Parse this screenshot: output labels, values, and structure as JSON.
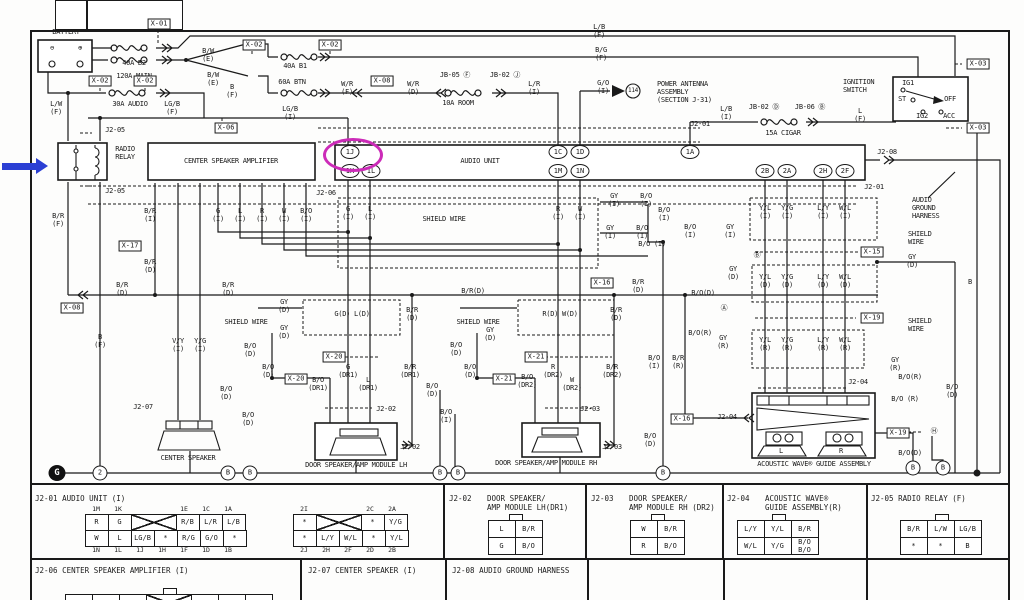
{
  "annotations": {
    "highlighted_pin": "1J",
    "highlight_color": "#cc2bb8",
    "pointer_arrow_color": "#2b3fd4",
    "pointer_target": "RADIO RELAY"
  },
  "diagram": {
    "wire_labels": [
      {
        "t": "BATTERY",
        "x": 66,
        "y": 32,
        "n": "battery-title"
      },
      {
        "t": "⊖",
        "x": 52,
        "y": 48
      },
      {
        "t": "⊕",
        "x": 80,
        "y": 48
      },
      {
        "t": "40A B2",
        "x": 134,
        "y": 63
      },
      {
        "t": "120A MAIN",
        "x": 134,
        "y": 76
      },
      {
        "t": "B/W\n(E)",
        "x": 208,
        "y": 55
      },
      {
        "t": "B/W\n(E)",
        "x": 213,
        "y": 79
      },
      {
        "t": "B\n(F)",
        "x": 232,
        "y": 91
      },
      {
        "t": "30A AUDIO",
        "x": 130,
        "y": 104
      },
      {
        "t": "L/W\n(F)",
        "x": 56,
        "y": 108
      },
      {
        "t": "LG/B\n(F)",
        "x": 172,
        "y": 108
      },
      {
        "t": "40A B1",
        "x": 295,
        "y": 66
      },
      {
        "t": "60A BTN",
        "x": 292,
        "y": 82
      },
      {
        "t": "W/R\n(F)",
        "x": 347,
        "y": 88
      },
      {
        "t": "W/R\n(D)",
        "x": 413,
        "y": 88
      },
      {
        "t": "JB-05 Ⓕ",
        "x": 455,
        "y": 75
      },
      {
        "t": "JB-02 Ⓙ",
        "x": 505,
        "y": 75
      },
      {
        "t": "10A ROOM",
        "x": 458,
        "y": 103
      },
      {
        "t": "L/R\n(I)",
        "x": 534,
        "y": 88
      },
      {
        "t": "LG/B\n(I)",
        "x": 290,
        "y": 113
      },
      {
        "t": "L/B\n(F)",
        "x": 599,
        "y": 31
      },
      {
        "t": "B/G\n(F)",
        "x": 601,
        "y": 54
      },
      {
        "t": "G/O\n(I)",
        "x": 603,
        "y": 87
      },
      {
        "t": "114",
        "x": 633,
        "y": 91,
        "s": 1
      },
      {
        "t": "POWER ANTENNA\nASSEMBLY\n(SECTION J-31)",
        "x": 657,
        "y": 92,
        "a": 1,
        "n": "power-antenna-title"
      },
      {
        "t": "IGNITION\nSWITCH",
        "x": 843,
        "y": 86,
        "a": 1,
        "n": "ignition-switch-title"
      },
      {
        "t": "IG1",
        "x": 908,
        "y": 83
      },
      {
        "t": "ST",
        "x": 902,
        "y": 99
      },
      {
        "t": "OFF",
        "x": 950,
        "y": 99
      },
      {
        "t": "IG2",
        "x": 922,
        "y": 116
      },
      {
        "t": "ACC",
        "x": 949,
        "y": 116
      },
      {
        "t": "JB-02 Ⓓ",
        "x": 764,
        "y": 107
      },
      {
        "t": "JB-06 Ⓑ",
        "x": 810,
        "y": 107
      },
      {
        "t": "15A CIGAR",
        "x": 783,
        "y": 133
      },
      {
        "t": "L/B\n(I)",
        "x": 726,
        "y": 113
      },
      {
        "t": "L\n(F)",
        "x": 860,
        "y": 115
      },
      {
        "t": "J2-01",
        "x": 700,
        "y": 124
      },
      {
        "t": "J2-05",
        "x": 115,
        "y": 130
      },
      {
        "t": "J2-05",
        "x": 115,
        "y": 191
      },
      {
        "t": "RADIO\nRELAY",
        "x": 125,
        "y": 153,
        "n": "radio-relay-title"
      },
      {
        "t": "CENTER SPEAKER AMPLIFIER",
        "x": 231,
        "y": 161,
        "n": "center-speaker-amplifier-title"
      },
      {
        "t": "AUDIO UNIT",
        "x": 480,
        "y": 161,
        "n": "audio-unit-title"
      },
      {
        "t": "J2-06",
        "x": 326,
        "y": 193
      },
      {
        "t": "J2-08",
        "x": 887,
        "y": 152
      },
      {
        "t": "J2-01",
        "x": 874,
        "y": 187
      },
      {
        "t": "AUDIO\nGROUND\nHARNESS",
        "x": 912,
        "y": 208,
        "a": 1,
        "n": "audio-ground-harness-label"
      },
      {
        "t": "B/R\n(F)",
        "x": 58,
        "y": 220
      },
      {
        "t": "B/R\n(I)",
        "x": 150,
        "y": 215
      },
      {
        "t": "G\n(I)",
        "x": 218,
        "y": 215
      },
      {
        "t": "L\n(I)",
        "x": 240,
        "y": 215
      },
      {
        "t": "R\n(I)",
        "x": 262,
        "y": 215
      },
      {
        "t": "W\n(I)",
        "x": 284,
        "y": 215
      },
      {
        "t": "B/O\n(I)",
        "x": 306,
        "y": 215
      },
      {
        "t": "B/R\n(D)",
        "x": 150,
        "y": 266
      },
      {
        "t": "B/R\n(D)",
        "x": 122,
        "y": 289
      },
      {
        "t": "B/R\n(D)",
        "x": 228,
        "y": 289
      },
      {
        "t": "G\n(I)",
        "x": 348,
        "y": 213
      },
      {
        "t": "L\n(I)",
        "x": 370,
        "y": 213
      },
      {
        "t": "SHIELD WIRE",
        "x": 444,
        "y": 219
      },
      {
        "t": "R\n(I)",
        "x": 558,
        "y": 213
      },
      {
        "t": "W\n(I)",
        "x": 580,
        "y": 213
      },
      {
        "t": "GY\n(I)",
        "x": 614,
        "y": 200
      },
      {
        "t": "B/O\n(I)",
        "x": 646,
        "y": 200
      },
      {
        "t": "GY\n(I)",
        "x": 610,
        "y": 232
      },
      {
        "t": "B/O\n(I)",
        "x": 642,
        "y": 232
      },
      {
        "t": "B/O (I)",
        "x": 652,
        "y": 244
      },
      {
        "t": "B/O\n(I)",
        "x": 664,
        "y": 214
      },
      {
        "t": "B/O\n(I)",
        "x": 690,
        "y": 231
      },
      {
        "t": "GY\n(I)",
        "x": 730,
        "y": 231
      },
      {
        "t": "Y/L\n(I)",
        "x": 765,
        "y": 212
      },
      {
        "t": "Y/G\n(I)",
        "x": 787,
        "y": 212
      },
      {
        "t": "L/Y\n(I)",
        "x": 823,
        "y": 212
      },
      {
        "t": "W/L\n(I)",
        "x": 845,
        "y": 212
      },
      {
        "t": "SHIELD\nWIRE",
        "x": 908,
        "y": 238,
        "a": 1
      },
      {
        "t": "Ⓑ",
        "x": 757,
        "y": 255
      },
      {
        "t": "GY\n(D)",
        "x": 912,
        "y": 261
      },
      {
        "t": "Y/L\n(D)",
        "x": 765,
        "y": 281
      },
      {
        "t": "Y/G\n(D)",
        "x": 787,
        "y": 281
      },
      {
        "t": "L/Y\n(D)",
        "x": 823,
        "y": 281
      },
      {
        "t": "W/L\n(D)",
        "x": 845,
        "y": 281
      },
      {
        "t": "GY\n(D)",
        "x": 733,
        "y": 273
      },
      {
        "t": "B/O(D)",
        "x": 703,
        "y": 293
      },
      {
        "t": "Ⓐ",
        "x": 724,
        "y": 308
      },
      {
        "t": "SHIELD\nWIRE",
        "x": 908,
        "y": 325,
        "a": 1
      },
      {
        "t": "B",
        "x": 970,
        "y": 282
      },
      {
        "t": "B/R(D)",
        "x": 473,
        "y": 291
      },
      {
        "t": "B/R\n(D)",
        "x": 638,
        "y": 286
      },
      {
        "t": "B\n(F)",
        "x": 100,
        "y": 341
      },
      {
        "t": "V/Y\n(I)",
        "x": 178,
        "y": 345
      },
      {
        "t": "Y/G\n(I)",
        "x": 200,
        "y": 345
      },
      {
        "t": "J2-07",
        "x": 143,
        "y": 407
      },
      {
        "t": "GY\n(D)",
        "x": 284,
        "y": 306
      },
      {
        "t": "SHIELD WIRE",
        "x": 246,
        "y": 322
      },
      {
        "t": "GY\n(D)",
        "x": 284,
        "y": 332
      },
      {
        "t": "B/O\n(D)",
        "x": 250,
        "y": 350
      },
      {
        "t": "B/O\n(D)",
        "x": 268,
        "y": 371
      },
      {
        "t": "B/O\n(D)",
        "x": 226,
        "y": 393
      },
      {
        "t": "G(D) L(D)",
        "x": 352,
        "y": 314
      },
      {
        "t": "B/R\n(D)",
        "x": 412,
        "y": 314
      },
      {
        "t": "G\n(DR1)",
        "x": 348,
        "y": 371
      },
      {
        "t": "L\n(DR1)",
        "x": 368,
        "y": 384
      },
      {
        "t": "B/O\n(DR1)",
        "x": 318,
        "y": 384
      },
      {
        "t": "B/R\n(DR1)",
        "x": 410,
        "y": 371
      },
      {
        "t": "J2-02",
        "x": 386,
        "y": 409
      },
      {
        "t": "J2-02",
        "x": 410,
        "y": 447
      },
      {
        "t": "B/O\n(D)",
        "x": 432,
        "y": 390
      },
      {
        "t": "SHIELD WIRE",
        "x": 478,
        "y": 322
      },
      {
        "t": "GY\n(D)",
        "x": 490,
        "y": 334
      },
      {
        "t": "B/O\n(D)",
        "x": 456,
        "y": 349
      },
      {
        "t": "B/O\n(D)",
        "x": 470,
        "y": 371
      },
      {
        "t": "R(D) W(D)",
        "x": 560,
        "y": 314
      },
      {
        "t": "B/R\n(D)",
        "x": 616,
        "y": 314
      },
      {
        "t": "R\n(DR2)",
        "x": 553,
        "y": 371
      },
      {
        "t": "W\n(DR2)",
        "x": 572,
        "y": 384
      },
      {
        "t": "B/O\n(DR2)",
        "x": 527,
        "y": 381
      },
      {
        "t": "B/R\n(DR2)",
        "x": 612,
        "y": 371
      },
      {
        "t": "J2-03",
        "x": 590,
        "y": 409
      },
      {
        "t": "J2-03",
        "x": 612,
        "y": 447
      },
      {
        "t": "B/O\n(I)",
        "x": 654,
        "y": 362
      },
      {
        "t": "B/R\n(R)",
        "x": 678,
        "y": 362
      },
      {
        "t": "B/O(R)",
        "x": 700,
        "y": 333
      },
      {
        "t": "GY\n(R)",
        "x": 723,
        "y": 342
      },
      {
        "t": "Y/L\n(R)",
        "x": 765,
        "y": 344
      },
      {
        "t": "Y/G\n(R)",
        "x": 787,
        "y": 344
      },
      {
        "t": "L/Y\n(R)",
        "x": 823,
        "y": 344
      },
      {
        "t": "W/L\n(R)",
        "x": 845,
        "y": 344
      },
      {
        "t": "J2-04",
        "x": 727,
        "y": 417
      },
      {
        "t": "J2-04",
        "x": 858,
        "y": 382
      },
      {
        "t": "GY\n(R)",
        "x": 895,
        "y": 364
      },
      {
        "t": "B/O(R)",
        "x": 910,
        "y": 377
      },
      {
        "t": "B/O (R)",
        "x": 905,
        "y": 399
      },
      {
        "t": "Ⓗ",
        "x": 934,
        "y": 431
      },
      {
        "t": "B/O\n(D)",
        "x": 952,
        "y": 391
      },
      {
        "t": "B/O(D)",
        "x": 910,
        "y": 453
      },
      {
        "t": "B/O\n(D)",
        "x": 650,
        "y": 440
      },
      {
        "t": "B/O\n(D)",
        "x": 248,
        "y": 419
      },
      {
        "t": "B/O\n(I)",
        "x": 446,
        "y": 416
      },
      {
        "t": "X-16",
        "x": 0,
        "y": 0,
        "s": 1
      },
      {
        "t": "CENTER SPEAKER",
        "x": 188,
        "y": 458,
        "n": "center-speaker-title"
      },
      {
        "t": "DOOR SPEAKER/AMP MODULE LH",
        "x": 356,
        "y": 465,
        "n": "door-speaker-lh-title"
      },
      {
        "t": "DOOR SPEAKER/AMP MODULE RH",
        "x": 546,
        "y": 463,
        "n": "door-speaker-rh-title"
      },
      {
        "t": "ACOUSTIC WAVE® GUIDE ASSEMBLY",
        "x": 814,
        "y": 464,
        "n": "acoustic-wave-title"
      },
      {
        "t": "L",
        "x": 781,
        "y": 451
      },
      {
        "t": "R",
        "x": 841,
        "y": 451
      }
    ],
    "connector_boxes": [
      {
        "t": "X-01",
        "x": 159,
        "y": 24
      },
      {
        "t": "X-02",
        "x": 254,
        "y": 45
      },
      {
        "t": "X-02",
        "x": 330,
        "y": 45
      },
      {
        "t": "X-02",
        "x": 100,
        "y": 81
      },
      {
        "t": "X-02",
        "x": 145,
        "y": 81
      },
      {
        "t": "X-06",
        "x": 226,
        "y": 128
      },
      {
        "t": "X-08",
        "x": 382,
        "y": 81
      },
      {
        "t": "X-03",
        "x": 978,
        "y": 64
      },
      {
        "t": "X-03",
        "x": 978,
        "y": 128
      },
      {
        "t": "X-17",
        "x": 130,
        "y": 246
      },
      {
        "t": "X-08",
        "x": 72,
        "y": 308
      },
      {
        "t": "X-15",
        "x": 872,
        "y": 252
      },
      {
        "t": "X-16",
        "x": 602,
        "y": 283
      },
      {
        "t": "X-20",
        "x": 334,
        "y": 357
      },
      {
        "t": "X-20",
        "x": 296,
        "y": 379
      },
      {
        "t": "X-21",
        "x": 536,
        "y": 357
      },
      {
        "t": "X-21",
        "x": 504,
        "y": 379
      },
      {
        "t": "X-16",
        "x": 682,
        "y": 419
      },
      {
        "t": "X-19",
        "x": 872,
        "y": 318
      },
      {
        "t": "X-19",
        "x": 898,
        "y": 433
      }
    ],
    "pins": [
      {
        "id": "1J",
        "x": 350,
        "y": 152
      },
      {
        "id": "1K",
        "x": 350,
        "y": 171
      },
      {
        "id": "1L",
        "x": 371,
        "y": 171
      },
      {
        "id": "1C",
        "x": 558,
        "y": 152
      },
      {
        "id": "1D",
        "x": 580,
        "y": 152
      },
      {
        "id": "1M",
        "x": 558,
        "y": 171
      },
      {
        "id": "1N",
        "x": 580,
        "y": 171
      },
      {
        "id": "1A",
        "x": 690,
        "y": 152
      },
      {
        "id": "2B",
        "x": 765,
        "y": 171
      },
      {
        "id": "2A",
        "x": 787,
        "y": 171
      },
      {
        "id": "2H",
        "x": 823,
        "y": 171
      },
      {
        "id": "2F",
        "x": 845,
        "y": 171
      }
    ],
    "grounds": [
      {
        "t": "2",
        "x": 100,
        "y": 473
      },
      {
        "t": "B",
        "x": 228,
        "y": 473
      },
      {
        "t": "B",
        "x": 250,
        "y": 473
      },
      {
        "t": "B",
        "x": 440,
        "y": 473
      },
      {
        "t": "B",
        "x": 458,
        "y": 473
      },
      {
        "t": "B",
        "x": 663,
        "y": 473
      },
      {
        "t": "B",
        "x": 913,
        "y": 468
      },
      {
        "t": "B",
        "x": 943,
        "y": 468
      }
    ],
    "ground_symbol": "G"
  },
  "tables": {
    "j2_01": {
      "title": "J2-01  AUDIO UNIT (I)",
      "left": {
        "top": [
          "1M",
          "1K",
          "",
          "",
          "1E",
          "1C",
          "1A"
        ],
        "row1": [
          "R",
          "G",
          "X2",
          "R/B",
          "L/R",
          "L/B"
        ],
        "row2": [
          "W",
          "L",
          "LG/B",
          "*",
          "R/G",
          "G/O",
          "*"
        ],
        "bottom": [
          "1N",
          "1L",
          "1J",
          "1H",
          "1F",
          "1D",
          "1B"
        ]
      },
      "right": {
        "top": [
          "2I",
          "",
          "",
          "2C",
          "2A"
        ],
        "row1": [
          "*",
          "X2",
          "*",
          "Y/G"
        ],
        "row2": [
          "*",
          "L/Y",
          "W/L",
          "*",
          "Y/L"
        ],
        "bottom": [
          "2J",
          "2H",
          "2F",
          "2D",
          "2B"
        ]
      }
    },
    "j2_02": {
      "title": "J2-02",
      "subtitle": "DOOR SPEAKER/\nAMP MODULE LH(DR1)",
      "rows": [
        [
          "L",
          "B/R"
        ],
        [
          "G",
          "B/O"
        ]
      ]
    },
    "j2_03": {
      "title": "J2-03",
      "subtitle": "DOOR SPEAKER/\nAMP MODULE RH (DR2)",
      "rows": [
        [
          "W",
          "B/R"
        ],
        [
          "R",
          "B/O"
        ]
      ]
    },
    "j2_04": {
      "title": "J2-04",
      "subtitle": "ACOUSTIC WAVE®\nGUIDE ASSEMBLY(R)",
      "rows": [
        [
          "L/Y",
          "Y/L",
          "B/R"
        ],
        [
          "W/L",
          "Y/G",
          "B/O\nB/O"
        ]
      ]
    },
    "j2_05": {
      "title": "J2-05  RADIO RELAY (F)",
      "rows": [
        [
          "B/R",
          "L/W",
          "LG/B"
        ],
        [
          "*",
          "*",
          "B"
        ]
      ]
    },
    "j2_06": {
      "title": "J2-06  CENTER SPEAKER AMPLIFIER (I)",
      "rows": [
        [
          "B",
          "G",
          "*",
          "X2",
          "*",
          "*",
          "*"
        ]
      ]
    },
    "j2_07": {
      "title": "J2-07  CENTER SPEAKER (I)"
    },
    "j2_08": {
      "title": "J2-08  AUDIO GROUND HARNESS"
    }
  }
}
